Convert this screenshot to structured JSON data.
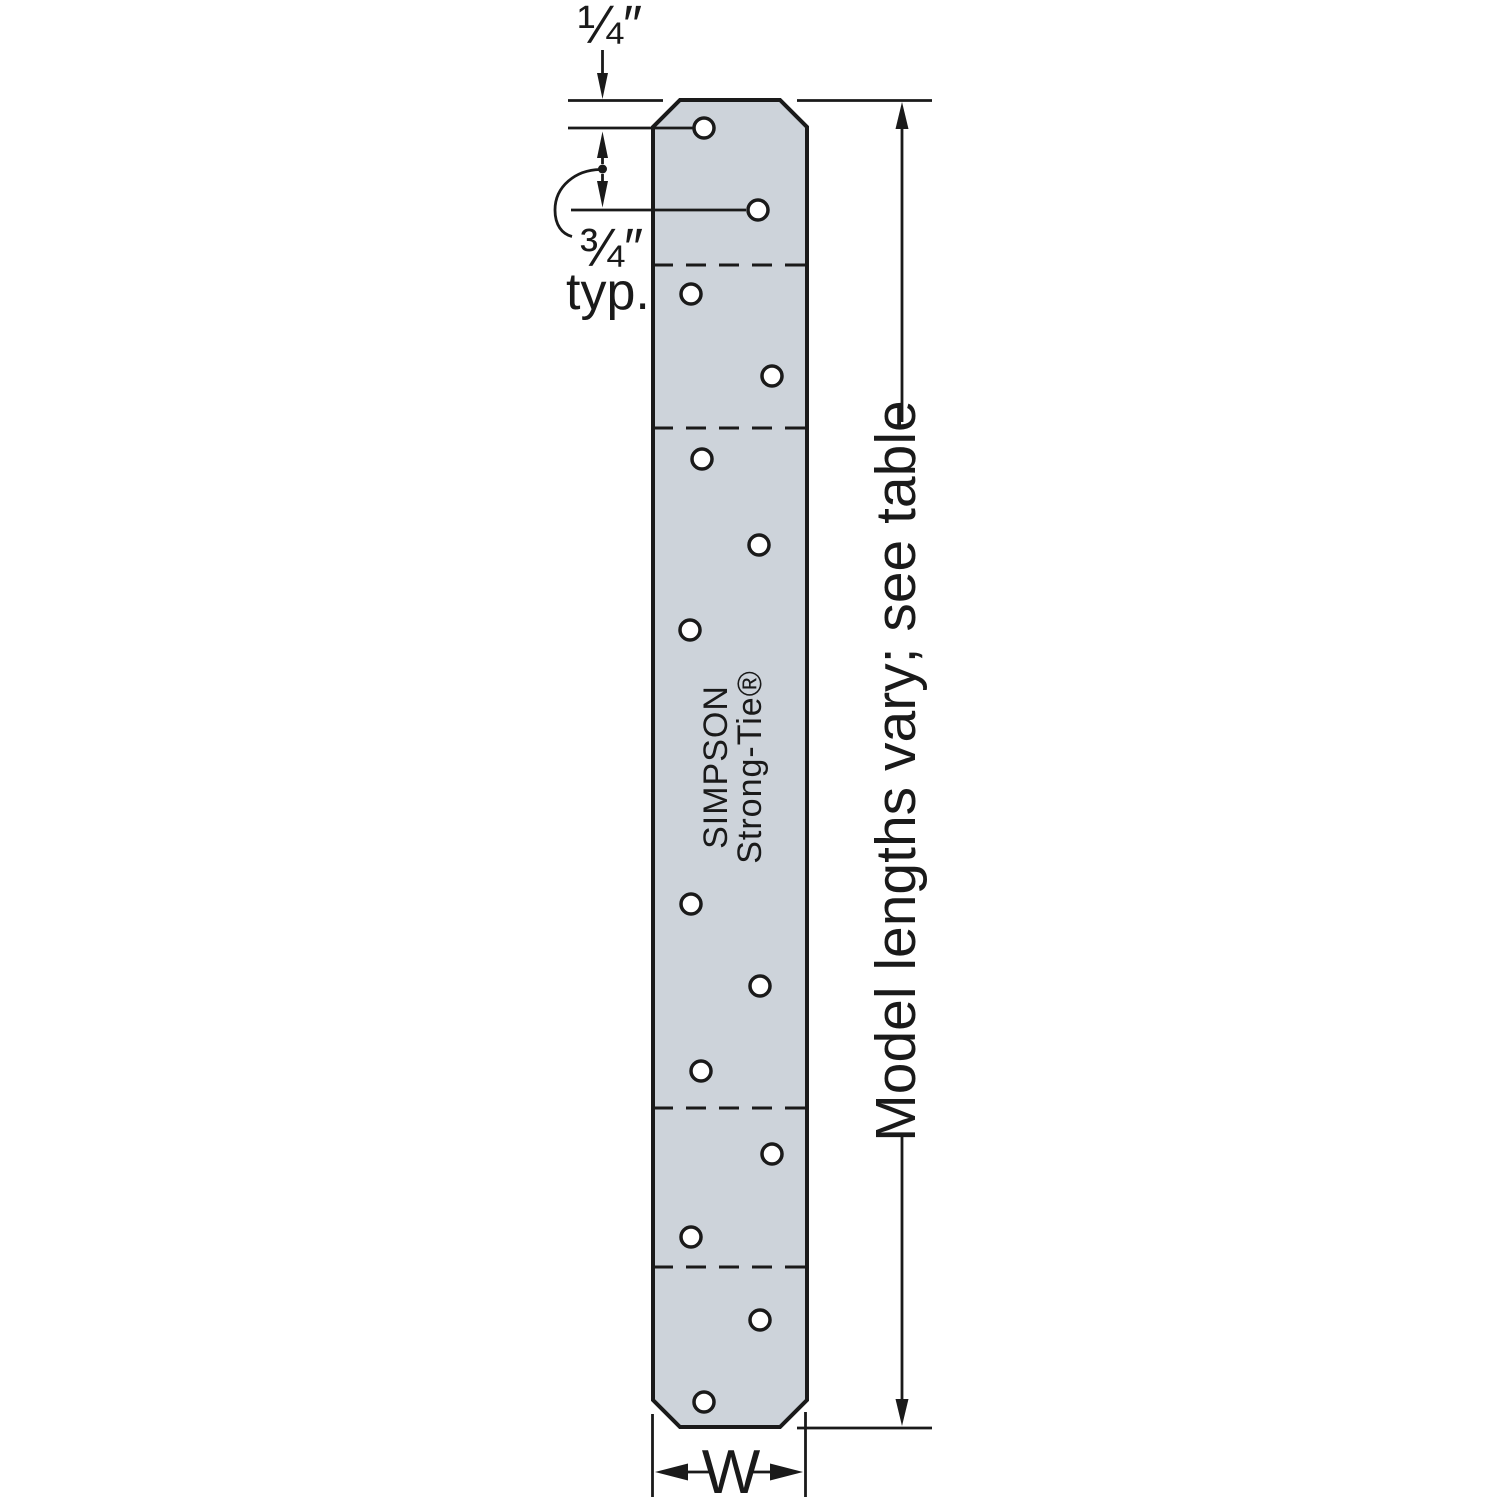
{
  "annotations": {
    "end_distance_label": "¼″",
    "hole_spacing_label": "¾″",
    "typical_label": "typ.",
    "length_note": "Model lengths vary; see table",
    "width_label": "W"
  },
  "plate_stamp": {
    "line1": "SIMPSON",
    "line2": "Strong-Tie®"
  },
  "colors": {
    "background": "#ffffff",
    "plate_fill": "#cdd3da",
    "hole_fill": "#ffffff",
    "line": "#1a1a1a"
  },
  "plate_geometry": {
    "left": 653,
    "right": 807,
    "top": 100,
    "bottom": 1427,
    "chamfer": 27,
    "hole_radius": 10,
    "holes": [
      [
        704,
        128
      ],
      [
        758,
        210
      ],
      [
        691,
        294
      ],
      [
        772,
        376
      ],
      [
        702,
        459
      ],
      [
        759,
        545
      ],
      [
        690,
        630
      ],
      [
        691,
        904
      ],
      [
        760,
        986
      ],
      [
        701,
        1071
      ],
      [
        772,
        1154
      ],
      [
        691,
        1237
      ],
      [
        760,
        1320
      ],
      [
        704,
        1402
      ]
    ],
    "dashed_lines_y": [
      265,
      428,
      1108,
      1267
    ]
  }
}
